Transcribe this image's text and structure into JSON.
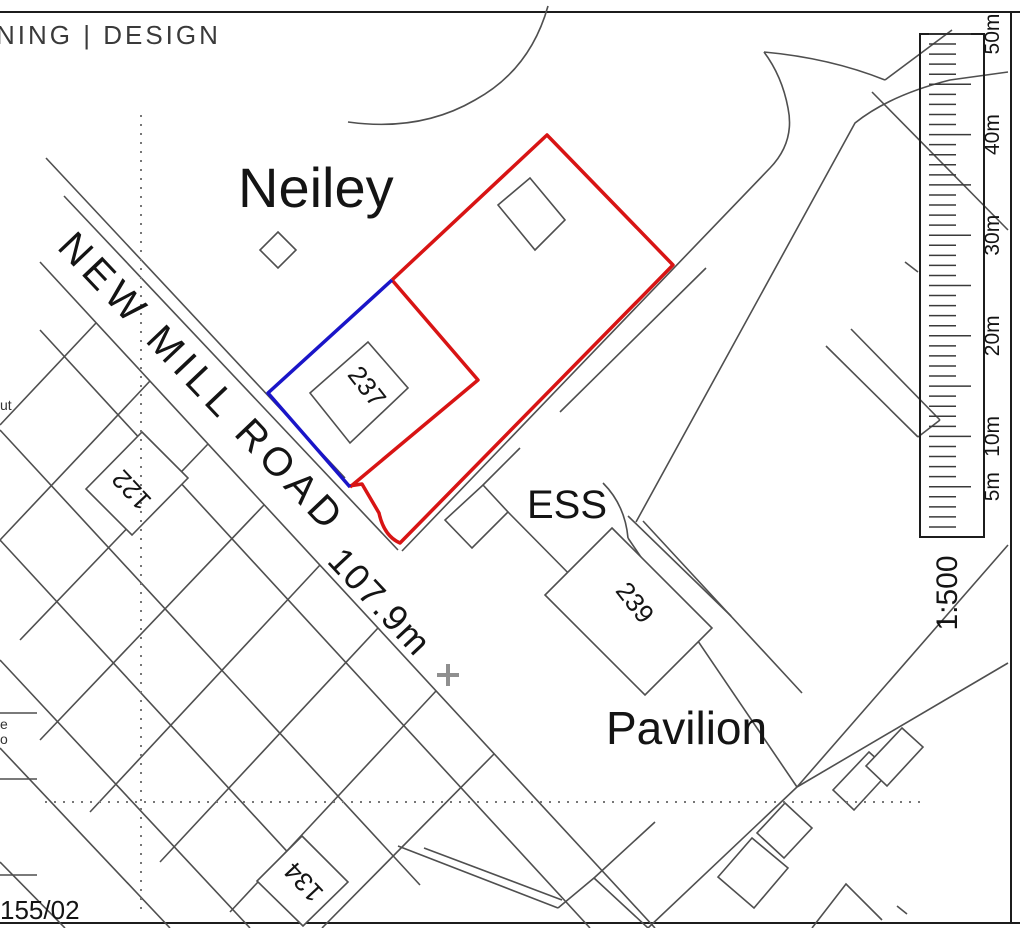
{
  "brand": {
    "text": "NING | DESIGN"
  },
  "map_labels": {
    "area_name": "Neiley",
    "road_name": "NEW MILL ROAD",
    "spot_height": "107.9m",
    "house_237": "237",
    "house_122": "122",
    "house_134": "134",
    "house_239": "239",
    "substation": "ESS",
    "pavilion": "Pavilion",
    "drawing_ref": "155/02",
    "clipped_text_ut": "ut",
    "clipped_text_e": "e",
    "clipped_text_o": "o"
  },
  "scale_bar": {
    "ratio": "1:500",
    "ticks": [
      {
        "label": "5m",
        "meters": 5
      },
      {
        "label": "10m",
        "meters": 10
      },
      {
        "label": "20m",
        "meters": 20
      },
      {
        "label": "30m",
        "meters": 30
      },
      {
        "label": "40m",
        "meters": 40
      },
      {
        "label": "50m",
        "meters": 50
      }
    ]
  },
  "colors": {
    "application_site_boundary": "#d81414",
    "ownership_boundary": "#1a15c8",
    "linework": "#4f4f4f"
  }
}
